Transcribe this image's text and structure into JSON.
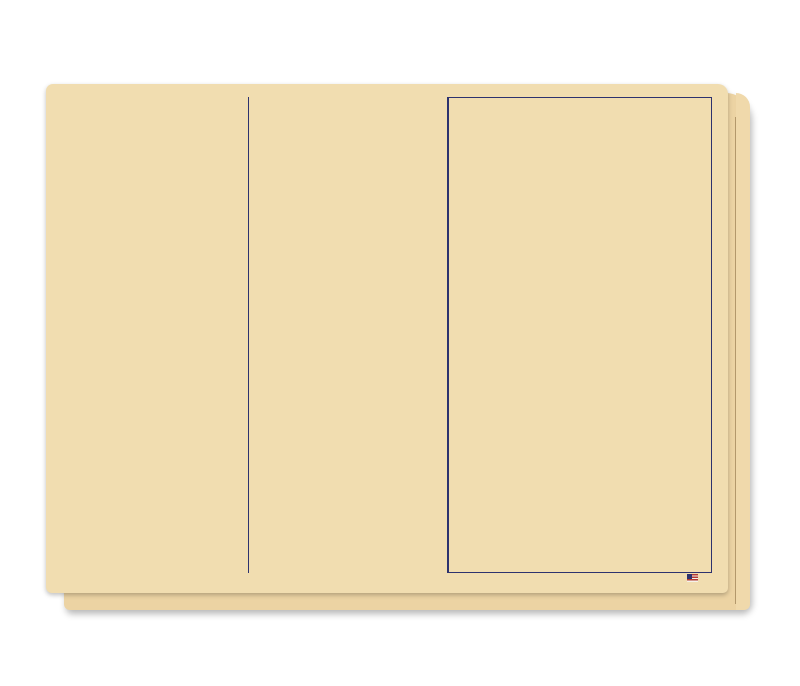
{
  "colors": {
    "background": "#ffffff",
    "sheet": "#f1ddb0",
    "sheet_behind": "#ecd3a3",
    "ink": "#2d326e",
    "mauve": "#c4a9a6",
    "peach": "#f6c494",
    "red": "#df4532"
  },
  "title": "VEHICLE INV. & SALE",
  "footer": {
    "item_no": "ITEM #5661",
    "form_no": "FORM #338",
    "made_in": "MADE IN THE U.S.A."
  },
  "left": {
    "labels": {
      "name": "NAME",
      "address": "ADDRESS",
      "city_state": "CITY & STATE",
      "zip_code": "ZIP CODE",
      "phone": "PHONE",
      "stock_no": "STOCK NO.",
      "new": "NEW",
      "used": "USED",
      "year": "YEAR",
      "make": "MAKE",
      "model": "MODEL",
      "body": "BODY",
      "vin": "VIN",
      "motor_no": "MOTOR NO.",
      "ign_key_no": "IGN. KEY NO.",
      "trunk_key_no": "TRUNK KEY NO.",
      "paint": "PAINT",
      "trim": "TRIM",
      "salesman": "SALESMAN",
      "salesman_no": "SALESMAN NO.",
      "license_no": "LICENSE\nNO.",
      "tab_no": "TAB\nNO.",
      "registration_card": "REGISTRATION CARD",
      "certificate_of_ownership": "CERTIFICATE\nOF OWNERSHIP"
    },
    "blank_row_count": 8,
    "contract": {
      "header": "CONTRACT SOLD DISCOUNTED",
      "rows": [
        "TO",
        "CASH",
        "HOLD OUT",
        "RESERVE",
        "LICENSE & TRANSFER",
        "INSURANCE",
        "TOTAL"
      ]
    }
  },
  "middle": {
    "purchased_from": "PURCHASED\nFROM",
    "address": "ADDRESS",
    "city": "CITY",
    "state": "STATE",
    "phone": "PHONE",
    "cost_of_car": "COST OF CAR",
    "options": "OPTIONS",
    "option_row_count": 3,
    "dealer_accessories": "DEALER INSTALLED ACCESSORIES",
    "dealer_row_count": 13,
    "total_cost_of_car": "TOTAL COST OF CAR",
    "flooring": {
      "title": "FLOORING",
      "rows": [
        {
          "label": "DATE"
        },
        {
          "label": "DATE\nPAID",
          "interest": "INTEREST"
        },
        {
          "label": "DATE"
        },
        {
          "label": "DATE\nPAID",
          "interest": "INTEREST"
        }
      ]
    },
    "commission": {
      "title": "COMMISSION",
      "base": "BASE",
      "access": "ACCESS.",
      "blank_row_count": 2,
      "total": "TOTAL"
    }
  },
  "right": {
    "purchase_date": "PURCHASE\nDATE",
    "sources": [
      "SOURCE - N.C.\n75(0)   FACTORY",
      "SOURCE - N.C.\n71(0)   DEALER",
      "SOURCE - USED CAR\n74(0)"
    ],
    "voucher": {
      "voucher_no": "VOUCHER NO.",
      "stock_no": "STOCK NO.",
      "key": "KEY",
      "key_value": "I"
    },
    "ledger": {
      "headers": {
        "account": "ACCOUNT",
        "vin": "VIN",
        "key": "KEY",
        "acct_no": "ACC'T NO.",
        "amount": "AMOUNT",
        "key2": "KEY"
      },
      "rows": [
        {
          "label": "",
          "key": "C",
          "sign": "+"
        },
        {
          "label": "",
          "key": "C",
          "sign": "+"
        },
        {
          "label": "",
          "key": "C",
          "sign": "+"
        },
        {
          "label": "",
          "key": "C",
          "sign": "+"
        },
        {
          "label": "",
          "key": "C",
          "sign": ""
        },
        {
          "label": "NOTES PAY",
          "key": "C",
          "sign": "−"
        },
        {
          "label": "",
          "key": "I",
          "sign": "−"
        }
      ]
    },
    "vehicle_sale": {
      "band": "VEHICLE SALE",
      "headers": {
        "date": "DATE",
        "invoice_no": "INVOICE NO.",
        "stock_no": "STOCK NO.",
        "key": "KEY"
      },
      "key_value": "I",
      "car_sales_source": {
        "label": "CAR SALES - SOURCE",
        "codes": [
          "10 (0)",
          "12 (0)",
          "20 (0)"
        ]
      },
      "sale_headers": {
        "cost": "COST",
        "key": "KEY",
        "acct_no": "ACC'T NO.",
        "sale": "SALE",
        "key2": "KEY"
      },
      "c_rows": [
        {
          "key": "C",
          "sign": "−"
        },
        {
          "key": "C",
          "sign": "−"
        },
        {
          "key": "C",
          "sign": "−"
        },
        {
          "key": "C",
          "sign": "−"
        },
        {
          "key": "C",
          "sign": "−"
        },
        {
          "key": "C",
          "sign": "−"
        },
        {
          "key": "C",
          "sign": "−"
        },
        {
          "key": "C",
          "sign": "−"
        },
        {
          "key": "C",
          "sign": "−"
        },
        {
          "key": "C",
          "sign": "−"
        },
        {
          "key": "C",
          "sign": "−"
        }
      ],
      "plain_rows": [
        {
          "sign": "−"
        },
        {
          "sign": "−"
        },
        {
          "sign": "+"
        },
        {
          "sign": "−"
        }
      ],
      "total_label": "TOTAL",
      "car_deal": {
        "label": "CAR DEAL NO.",
        "key": "I"
      },
      "bottom_rows": [
        {
          "label": "SALES TAX",
          "sign": "−"
        },
        {
          "label": "LICENSE & TITLE",
          "sign": "−"
        },
        {
          "label": "",
          "sign": "−"
        },
        {
          "label": "DEPOSITS",
          "sign": "+"
        },
        {
          "label": "CASH & VEHICLE ACCTS. REC.",
          "sign": "+"
        },
        {
          "label": "",
          "sign": "+"
        },
        {
          "label": "LIEN PAYOFF",
          "sign": "−"
        },
        {
          "label": "CONTRACTS IN TRANSIT",
          "sign": "+"
        },
        {
          "label": "",
          "sign": "+"
        },
        {
          "label": "",
          "sign": "+"
        },
        {
          "label": "",
          "sign": "−"
        },
        {
          "label": "",
          "sign": "−"
        }
      ],
      "value_of_trade": {
        "label": "VALUE\nOF\nTRADE",
        "rows": [
          {
            "stock_no": "STOCK NO.",
            "key": "I",
            "sign": "+"
          },
          {
            "stock_no": "STOCK NO.",
            "key": "I",
            "sign": "+"
          }
        ]
      }
    }
  }
}
